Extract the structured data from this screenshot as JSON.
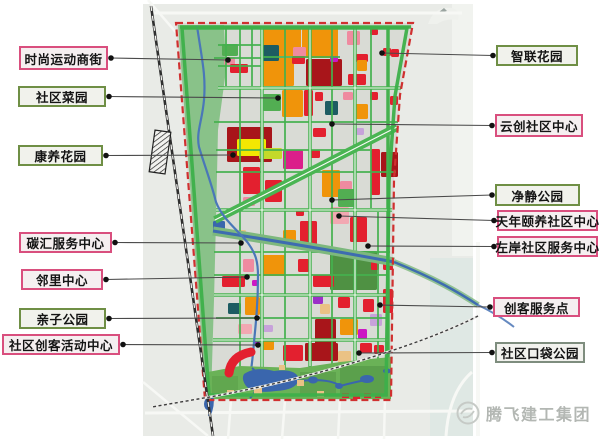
{
  "canvas": {
    "width": 600,
    "height": 439,
    "background": "#ffffff"
  },
  "watermark": {
    "text": "腾飞建工集团",
    "color": "#b3b7b3",
    "logo": "bird-circle"
  },
  "label_styles": {
    "pink": {
      "border": "#d94f7e",
      "fill": "#f5eff0"
    },
    "green": {
      "border": "#6f8f45",
      "fill": "#f1f2ec"
    },
    "gray": {
      "border": "#7e8d7e",
      "fill": "#f2f2ee"
    }
  },
  "leader": {
    "color": "#4a4a4a",
    "dot": "#111111"
  },
  "labels": {
    "left": [
      {
        "text": "时尚运动商街",
        "box": [
          19,
          46,
          89,
          24
        ],
        "anchor": [
          228,
          60
        ],
        "style": "pink"
      },
      {
        "text": "社区菜园",
        "box": [
          18,
          86,
          88,
          21
        ],
        "anchor": [
          278,
          98
        ],
        "style": "green"
      },
      {
        "text": "康养花园",
        "box": [
          18,
          145,
          85,
          21
        ],
        "anchor": [
          233,
          155
        ],
        "style": "green"
      },
      {
        "text": "碳汇服务中心",
        "box": [
          19,
          232,
          93,
          21
        ],
        "anchor": [
          241,
          243
        ],
        "style": "pink"
      },
      {
        "text": "邻里中心",
        "box": [
          21,
          269,
          82,
          21
        ],
        "anchor": [
          247,
          277
        ],
        "style": "pink"
      },
      {
        "text": "亲子公园",
        "box": [
          19,
          308,
          87,
          21
        ],
        "anchor": [
          257,
          318
        ],
        "style": "green"
      },
      {
        "text": "社区创客活动中心",
        "box": [
          2,
          334,
          118,
          21
        ],
        "anchor": [
          258,
          345
        ],
        "style": "pink"
      }
    ],
    "right": [
      {
        "text": "智联花园",
        "box": [
          496,
          45,
          82,
          21
        ],
        "anchor": [
          382,
          53
        ],
        "style": "green"
      },
      {
        "text": "云创社区中心",
        "box": [
          495,
          114,
          88,
          23
        ],
        "anchor": [
          332,
          124
        ],
        "style": "pink"
      },
      {
        "text": "净静公园",
        "box": [
          495,
          184,
          85,
          22
        ],
        "anchor": [
          332,
          200
        ],
        "style": "green"
      },
      {
        "text": "天年颐养社区中心",
        "box": [
          497,
          210,
          101,
          21
        ],
        "anchor": [
          339,
          216
        ],
        "style": "pink"
      },
      {
        "text": "左岸社区服务中心",
        "box": [
          497,
          236,
          101,
          21
        ],
        "anchor": [
          368,
          246
        ],
        "style": "pink"
      },
      {
        "text": "创客服务点",
        "box": [
          493,
          297,
          87,
          20
        ],
        "anchor": [
          380,
          305
        ],
        "style": "pink"
      },
      {
        "text": "社区口袋公园",
        "box": [
          495,
          342,
          90,
          21
        ],
        "anchor": [
          359,
          353
        ],
        "style": "gray"
      }
    ]
  },
  "palette": {
    "O": "#f0940a",
    "R": "#e3202f",
    "DR": "#a8151a",
    "P": "#ef8ba0",
    "LP": "#f2a8b2",
    "M": "#cc17c4",
    "MG": "#db1f8a",
    "PU": "#9b30c8",
    "LV": "#c7a2da",
    "T": "#1d5c62",
    "Y": "#f2e702",
    "LI": "#c4d92a",
    "G": "#52ae52",
    "DG": "#4f9143",
    "TN": "#eac285",
    "B": "#3a66ad"
  },
  "map": {
    "bg_rects": [
      [
        143,
        4,
        330,
        432,
        "#e9ebe7"
      ],
      [
        452,
        4,
        21,
        252,
        "#f1f3ef"
      ],
      [
        430,
        258,
        43,
        178,
        "#dfe8e4"
      ]
    ],
    "outside_lines": [
      [
        150,
        13,
        462,
        13,
        3
      ],
      [
        148,
        0,
        186,
        44,
        2.5
      ],
      [
        145,
        413,
        473,
        411,
        3
      ],
      [
        231,
        400,
        228,
        439,
        2.5
      ],
      [
        285,
        400,
        282,
        439,
        2.5
      ],
      [
        340,
        398,
        338,
        439,
        2.5
      ],
      [
        385,
        396,
        384,
        439,
        2.5
      ],
      [
        143,
        382,
        208,
        436,
        2.5
      ],
      [
        478,
        242,
        478,
        436,
        4
      ]
    ],
    "outside_paths": [
      "M446,436 Q449,392 472,372"
    ],
    "railway": {
      "line": "M151,6 L213,436",
      "station": {
        "x": 160,
        "y": 152,
        "w": 16,
        "h": 42,
        "angle": 8
      }
    },
    "rail2": "M478,316 C420,346 300,382 198,399 L152,407",
    "boundary_pts": "176,23 413,23 400,95 394,180 391,400 205,400",
    "boundary_fill": "#d9dbd5",
    "boundary_stroke": "#d03030",
    "ring_pts": "182,28 407,28 395,96 389,181 386,395 209,395",
    "ring_color": "#3db04a",
    "greenway_path": "M178,25 L224,25 L226,70 L218,130 L216,220 L214,300 L211,398 L206,398 Z",
    "greenway_fill": "#89c289",
    "minor_lines": [
      [
        226,
        28,
        226,
        86
      ],
      [
        252,
        28,
        252,
        86
      ],
      [
        218,
        45,
        262,
        45
      ],
      [
        218,
        66,
        262,
        66
      ],
      [
        262,
        57,
        340,
        57
      ],
      [
        240,
        28,
        240,
        370
      ],
      [
        285,
        28,
        285,
        368
      ],
      [
        332,
        28,
        332,
        365
      ],
      [
        371,
        28,
        371,
        208
      ],
      [
        378,
        212,
        378,
        362
      ],
      [
        214,
        122,
        398,
        122
      ],
      [
        216,
        150,
        370,
        150
      ],
      [
        216,
        172,
        396,
        172
      ],
      [
        214,
        252,
        390,
        252
      ],
      [
        214,
        275,
        388,
        275
      ],
      [
        216,
        318,
        388,
        318
      ],
      [
        214,
        58,
        262,
        58
      ]
    ],
    "major_lines": [
      [
        218,
        88,
        401,
        88
      ],
      [
        216,
        210,
        392,
        210
      ],
      [
        214,
        295,
        389,
        295
      ],
      [
        213,
        340,
        389,
        340
      ],
      [
        262,
        26,
        262,
        370
      ],
      [
        310,
        26,
        310,
        368
      ],
      [
        355,
        26,
        355,
        366
      ],
      [
        388,
        26,
        388,
        396
      ],
      [
        180,
        27,
        411,
        27
      ]
    ],
    "center_lines": [
      [
        218,
        88,
        400,
        88
      ],
      [
        216,
        210,
        392,
        210
      ],
      [
        262,
        28,
        262,
        368
      ],
      [
        310,
        28,
        310,
        366
      ],
      [
        355,
        28,
        355,
        364
      ],
      [
        214,
        295,
        388,
        295
      ],
      [
        213,
        340,
        388,
        340
      ]
    ],
    "road_green": "#45b14e",
    "road_white": "#fafaf7",
    "diagonal": [
      397,
      127,
      215,
      220
    ],
    "canal": {
      "inside": "M213,231 C270,240 330,250 394,262",
      "outside": "M394,262 C436,279 458,292 478,305",
      "ext": "M478,305 C495,313 505,320 514,327",
      "bank": "#7db87d",
      "water": "#3e6cb0"
    },
    "river": "M197,26 C202,60 206,75 204,100 C202,122 196,132 199,147 C205,167 211,182 216,202 C223,220 238,230 248,243 C256,254 258,262 258,276 C258,302 256,322 254,342 C253,356 252,362 251,371",
    "parcels": [
      [
        222,
        44,
        16,
        12,
        "G"
      ],
      [
        224,
        57,
        11,
        8,
        "P"
      ],
      [
        230,
        64,
        18,
        9,
        "R"
      ],
      [
        280,
        38,
        9,
        8,
        "O"
      ],
      [
        263,
        28,
        38,
        28,
        "O"
      ],
      [
        263,
        58,
        31,
        28,
        "O"
      ],
      [
        302,
        28,
        36,
        30,
        "O"
      ],
      [
        263,
        45,
        16,
        16,
        "T"
      ],
      [
        293,
        47,
        13,
        11,
        "P"
      ],
      [
        292,
        56,
        13,
        8,
        "R"
      ],
      [
        306,
        59,
        36,
        27,
        "DR"
      ],
      [
        330,
        56,
        8,
        6,
        "M"
      ],
      [
        356,
        54,
        12,
        8,
        "R"
      ],
      [
        347,
        31,
        13,
        14,
        "P"
      ],
      [
        383,
        48,
        8,
        8,
        "R"
      ],
      [
        391,
        49,
        8,
        8,
        "R"
      ],
      [
        357,
        60,
        10,
        11,
        "O"
      ],
      [
        348,
        74,
        18,
        11,
        "R"
      ],
      [
        370,
        29,
        8,
        6,
        "R"
      ],
      [
        263,
        94,
        18,
        17,
        "G"
      ],
      [
        282,
        90,
        21,
        27,
        "O"
      ],
      [
        304,
        90,
        9,
        26,
        "R"
      ],
      [
        325,
        101,
        13,
        14,
        "T"
      ],
      [
        315,
        92,
        8,
        9,
        "R"
      ],
      [
        355,
        104,
        13,
        15,
        "O"
      ],
      [
        370,
        92,
        8,
        8,
        "R"
      ],
      [
        343,
        92,
        10,
        8,
        "P"
      ],
      [
        390,
        96,
        8,
        9,
        "R"
      ],
      [
        227,
        127,
        45,
        35,
        "DR"
      ],
      [
        237,
        139,
        29,
        17,
        "Y"
      ],
      [
        259,
        148,
        23,
        11,
        "LI"
      ],
      [
        283,
        150,
        20,
        19,
        "MG"
      ],
      [
        243,
        167,
        17,
        27,
        "R"
      ],
      [
        265,
        180,
        17,
        22,
        "R"
      ],
      [
        243,
        197,
        12,
        9,
        "P"
      ],
      [
        322,
        170,
        18,
        27,
        "O"
      ],
      [
        340,
        181,
        12,
        10,
        "P"
      ],
      [
        371,
        149,
        9,
        46,
        "R"
      ],
      [
        381,
        152,
        17,
        25,
        "DR"
      ],
      [
        338,
        189,
        17,
        18,
        "G"
      ],
      [
        310,
        150,
        10,
        8,
        "R"
      ],
      [
        313,
        128,
        13,
        9,
        "R"
      ],
      [
        356,
        128,
        8,
        7,
        "LV"
      ],
      [
        330,
        207,
        19,
        17,
        "LP"
      ],
      [
        300,
        221,
        17,
        27,
        "R"
      ],
      [
        283,
        230,
        13,
        14,
        "O"
      ],
      [
        350,
        217,
        17,
        25,
        "R"
      ],
      [
        237,
        230,
        9,
        8,
        "TN"
      ],
      [
        213,
        221,
        12,
        12,
        "B"
      ],
      [
        296,
        210,
        8,
        6,
        "R"
      ],
      [
        330,
        251,
        47,
        39,
        "DG"
      ],
      [
        243,
        259,
        11,
        13,
        "P"
      ],
      [
        263,
        255,
        22,
        21,
        "O"
      ],
      [
        298,
        259,
        11,
        13,
        "R"
      ],
      [
        222,
        276,
        23,
        11,
        "R"
      ],
      [
        252,
        280,
        6,
        6,
        "M"
      ],
      [
        313,
        275,
        21,
        12,
        "R"
      ],
      [
        383,
        257,
        10,
        13,
        "R"
      ],
      [
        371,
        262,
        8,
        8,
        "R"
      ],
      [
        228,
        303,
        13,
        11,
        "T"
      ],
      [
        245,
        297,
        15,
        18,
        "O"
      ],
      [
        238,
        324,
        14,
        10,
        "LP"
      ],
      [
        263,
        325,
        10,
        7,
        "LV"
      ],
      [
        313,
        294,
        10,
        10,
        "PU"
      ],
      [
        315,
        319,
        21,
        26,
        "DR"
      ],
      [
        320,
        304,
        10,
        10,
        "TN"
      ],
      [
        340,
        319,
        18,
        16,
        "O"
      ],
      [
        358,
        329,
        9,
        10,
        "M"
      ],
      [
        370,
        314,
        12,
        12,
        "LV"
      ],
      [
        363,
        299,
        11,
        13,
        "R"
      ],
      [
        338,
        297,
        12,
        11,
        "R"
      ],
      [
        383,
        289,
        10,
        24,
        "R"
      ],
      [
        262,
        339,
        12,
        11,
        "O"
      ],
      [
        283,
        345,
        20,
        16,
        "R"
      ],
      [
        305,
        343,
        33,
        18,
        "DR"
      ],
      [
        338,
        351,
        13,
        12,
        "TN"
      ],
      [
        360,
        343,
        12,
        10,
        "R"
      ],
      [
        374,
        345,
        10,
        9,
        "R"
      ],
      [
        253,
        339,
        7,
        7,
        "PU"
      ]
    ],
    "park": {
      "base_pts": "208,372 240,366 300,368 340,362 391,357 391,399 207,399",
      "base_fill": "#6ab257",
      "dark_rects": [
        [
          340,
          366,
          48,
          30,
          0.55
        ],
        [
          300,
          372,
          36,
          24,
          0.45
        ],
        [
          212,
          376,
          26,
          20,
          0.35
        ]
      ],
      "lake": "M244,374 Q256,366 274,371 Q296,368 299,379 Q297,390 276,391 Q254,394 246,386 Q241,379 244,374",
      "ponds": [
        [
          313,
          380,
          5,
          3.5
        ],
        [
          339,
          386,
          4,
          3
        ],
        [
          367,
          379,
          7,
          4
        ],
        [
          387,
          371,
          4,
          2.5
        ]
      ],
      "streams": [
        "M252,368 Q262,376 258,388 Q254,394 250,398",
        "M299,381 Q330,378 340,386 Q355,382 366,380"
      ],
      "tans": [
        [
          254,
          387,
          8,
          7
        ],
        [
          297,
          380,
          7,
          6
        ],
        [
          317,
          391,
          7,
          6
        ],
        [
          279,
          365,
          6,
          5
        ],
        [
          227,
          390,
          7,
          6
        ]
      ],
      "reds": [
        [
          342,
          393,
          7,
          5
        ],
        [
          353,
          394,
          7,
          5
        ],
        [
          364,
          393,
          7,
          5
        ],
        [
          375,
          394,
          6,
          4
        ]
      ],
      "arc": "M229,373 Q231,356 251,352",
      "outlet": "M212,396 Q214,406 209,416",
      "outlet_blob": [
        208,
        404,
        4,
        6
      ]
    },
    "blob": {
      "path": "M428,24 Q434,6 452,8 Q460,10 458,20 Q446,18 437,24 Z",
      "fill": "#eff1ed",
      "mark": "M439,12 l5,-4 l3,3 l-4,1 z",
      "mark_fill": "#9aa4a0"
    }
  }
}
